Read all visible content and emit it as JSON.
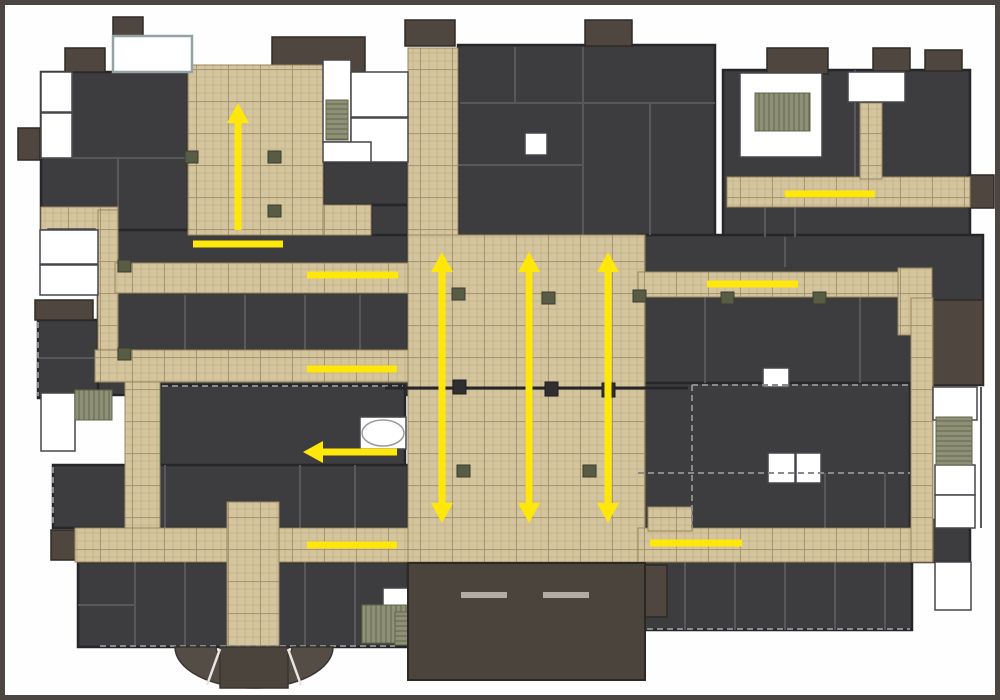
{
  "meta": {
    "diagram_type": "building-floor-plan-circulation",
    "canvas": {
      "w": 990,
      "h": 690
    }
  },
  "palette": {
    "frame": "#4b4641",
    "background": "#fefefe",
    "room_dark": "#3d3d3f",
    "room_wall": "#26262a",
    "interior_wall": "#57575c",
    "accent_block": "#4e463f",
    "accent_stroke": "#2f2a25",
    "corridor_base": "#d4c59e",
    "corridor_grout": "#b8a77e",
    "corridor_grid": "#9c8c66",
    "corridor_stroke": "#97855e",
    "white_room": "#ffffff",
    "white_room_stroke": "#46464c",
    "stairs": "#8e9177",
    "stairs_stripe": "#62654a",
    "column": "#585c45",
    "column_stroke": "#393d2b",
    "entrance_block": "#4a443d",
    "fan": "#544d46",
    "step_bar": "#b2ada4",
    "joint_line": "#262628",
    "dash_line": "#8a8a8a",
    "teal_border": "#93a3a3",
    "arrow_yellow": "#ffe70a"
  },
  "floor_plan": {
    "dark_masses": [
      [
        36,
        67,
        147,
        193
      ],
      [
        93,
        225,
        310,
        165
      ],
      [
        155,
        380,
        245,
        87
      ],
      [
        33,
        315,
        60,
        78
      ],
      [
        48,
        460,
        355,
        63
      ],
      [
        73,
        557,
        330,
        85
      ],
      [
        453,
        40,
        257,
        192
      ],
      [
        718,
        65,
        247,
        167
      ],
      [
        633,
        230,
        345,
        150
      ],
      [
        633,
        378,
        272,
        145
      ],
      [
        630,
        555,
        277,
        70
      ],
      [
        318,
        157,
        85,
        43
      ],
      [
        366,
        200,
        37,
        30
      ],
      [
        905,
        515,
        60,
        42
      ]
    ],
    "accent_blocks": [
      [
        108,
        12,
        30,
        21
      ],
      [
        60,
        43,
        40,
        24
      ],
      [
        267,
        32,
        93,
        35
      ],
      [
        400,
        15,
        50,
        26
      ],
      [
        580,
        15,
        47,
        26
      ],
      [
        762,
        43,
        61,
        26
      ],
      [
        868,
        43,
        37,
        23
      ],
      [
        920,
        45,
        37,
        21
      ],
      [
        13,
        123,
        22,
        32
      ],
      [
        30,
        295,
        58,
        20
      ],
      [
        46,
        525,
        26,
        30
      ],
      [
        928,
        295,
        50,
        85
      ],
      [
        963,
        170,
        26,
        33
      ],
      [
        636,
        560,
        26,
        52
      ]
    ],
    "interior_walls": [
      [
        578,
        42,
        578,
        230
      ],
      [
        455,
        98,
        710,
        98
      ],
      [
        510,
        42,
        510,
        98
      ],
      [
        645,
        98,
        645,
        230
      ],
      [
        453,
        160,
        578,
        160
      ],
      [
        850,
        65,
        850,
        172
      ],
      [
        790,
        200,
        790,
        232
      ],
      [
        760,
        200,
        760,
        232
      ],
      [
        700,
        292,
        700,
        378
      ],
      [
        780,
        232,
        780,
        262
      ],
      [
        855,
        292,
        855,
        378
      ],
      [
        820,
        468,
        820,
        523
      ],
      [
        880,
        468,
        880,
        523
      ],
      [
        180,
        290,
        180,
        345
      ],
      [
        240,
        290,
        240,
        345
      ],
      [
        300,
        290,
        300,
        345
      ],
      [
        355,
        290,
        355,
        345
      ],
      [
        160,
        460,
        160,
        523
      ],
      [
        295,
        460,
        295,
        523
      ],
      [
        350,
        460,
        350,
        523
      ],
      [
        130,
        557,
        130,
        642
      ],
      [
        180,
        557,
        180,
        642
      ],
      [
        300,
        557,
        300,
        642
      ],
      [
        350,
        557,
        350,
        642
      ],
      [
        73,
        600,
        130,
        600
      ],
      [
        680,
        555,
        680,
        625
      ],
      [
        730,
        555,
        730,
        625
      ],
      [
        780,
        555,
        780,
        625
      ],
      [
        830,
        555,
        830,
        625
      ],
      [
        880,
        555,
        880,
        625
      ],
      [
        36,
        153,
        183,
        153
      ],
      [
        113,
        153,
        113,
        202
      ],
      [
        67,
        67,
        67,
        153
      ],
      [
        33,
        353,
        93,
        353
      ],
      [
        520,
        562,
        520,
        670
      ],
      [
        976,
        382,
        976,
        523
      ]
    ],
    "corridors": [
      [
        36,
        202,
        77,
        58
      ],
      [
        183,
        60,
        135,
        170
      ],
      [
        318,
        200,
        48,
        30
      ],
      [
        93,
        205,
        20,
        172
      ],
      [
        110,
        258,
        293,
        30
      ],
      [
        90,
        345,
        313,
        32
      ],
      [
        120,
        377,
        35,
        148
      ],
      [
        70,
        523,
        335,
        34
      ],
      [
        222,
        497,
        52,
        145
      ],
      [
        403,
        43,
        50,
        187
      ],
      [
        403,
        230,
        237,
        327
      ],
      [
        633,
        267,
        262,
        25
      ],
      [
        893,
        263,
        34,
        67
      ],
      [
        906,
        293,
        22,
        264
      ],
      [
        633,
        523,
        273,
        34
      ],
      [
        643,
        502,
        44,
        24
      ],
      [
        722,
        172,
        243,
        30
      ],
      [
        855,
        98,
        22,
        76
      ]
    ],
    "white_rooms": [
      [
        36,
        67,
        31,
        40
      ],
      [
        36,
        108,
        31,
        45
      ],
      [
        43,
        224,
        47,
        36
      ],
      [
        35,
        225,
        58,
        34
      ],
      [
        35,
        260,
        58,
        30
      ],
      [
        318,
        55,
        28,
        82
      ],
      [
        346,
        67,
        57,
        45
      ],
      [
        346,
        113,
        57,
        44
      ],
      [
        318,
        137,
        48,
        20
      ],
      [
        735,
        68,
        82,
        84
      ],
      [
        843,
        67,
        57,
        30
      ],
      [
        763,
        448,
        27,
        30
      ],
      [
        791,
        448,
        25,
        30
      ],
      [
        928,
        382,
        44,
        33
      ],
      [
        930,
        460,
        40,
        30
      ],
      [
        930,
        490,
        40,
        33
      ],
      [
        36,
        388,
        34,
        58
      ],
      [
        378,
        583,
        25,
        25
      ],
      [
        930,
        557,
        36,
        48
      ],
      [
        520,
        128,
        22,
        22
      ],
      [
        758,
        363,
        26,
        19
      ],
      [
        355,
        412,
        46,
        32
      ]
    ],
    "teal_room": [
      108,
      31,
      79,
      36
    ],
    "stairs": [
      [
        321,
        95,
        22,
        40,
        "v"
      ],
      [
        750,
        88,
        55,
        38,
        "h"
      ],
      [
        931,
        412,
        36,
        48,
        "v"
      ],
      [
        70,
        385,
        37,
        30,
        "h"
      ],
      [
        357,
        600,
        46,
        38,
        "h"
      ],
      [
        390,
        607,
        14,
        33,
        "v"
      ]
    ],
    "dashed_lines": [
      [
        687,
        380,
        905,
        380
      ],
      [
        687,
        380,
        687,
        523
      ],
      [
        633,
        468,
        905,
        468
      ],
      [
        632,
        624,
        905,
        624
      ],
      [
        95,
        641,
        390,
        641
      ],
      [
        157,
        381,
        398,
        381
      ],
      [
        33,
        317,
        33,
        391
      ],
      [
        48,
        462,
        48,
        521
      ]
    ],
    "columns": [
      [
        180,
        146
      ],
      [
        263,
        146
      ],
      [
        263,
        200
      ],
      [
        113,
        255
      ],
      [
        113,
        343
      ],
      [
        447,
        283
      ],
      [
        537,
        287
      ],
      [
        628,
        285
      ],
      [
        716,
        287
      ],
      [
        808,
        287
      ],
      [
        452,
        460
      ],
      [
        578,
        460
      ]
    ],
    "joint": {
      "line": [
        380,
        383,
        683,
        383
      ],
      "bumps": [
        [
          448,
          375
        ],
        [
          540,
          377
        ],
        [
          597,
          378
        ]
      ]
    },
    "oval_table": {
      "cx": 378,
      "cy": 428,
      "rx": 21,
      "ry": 13
    },
    "entrance": {
      "block": [
        403,
        558,
        237,
        117
      ],
      "step_bars": [
        [
          456,
          587,
          46,
          6
        ],
        [
          538,
          587,
          46,
          6
        ]
      ]
    },
    "fan": {
      "cx": 249,
      "cy": 642,
      "rx_outer": 79,
      "ry_outer": 41,
      "rx_inner": 38,
      "ry_inner": 20,
      "center_rect": [
        215,
        642,
        68,
        41
      ],
      "dividers": [
        [
          215,
          644,
          202,
          680
        ],
        [
          283,
          644,
          296,
          680
        ]
      ]
    },
    "circulation_marks": [
      {
        "name": "up-arrow-northwest-lobby",
        "x1": 233,
        "y1": 225,
        "x2": 233,
        "y2": 98,
        "heads": [
          "end"
        ]
      },
      {
        "name": "flow-line-northwest-lower",
        "x1": 188,
        "y1": 239,
        "x2": 278,
        "y2": 239,
        "heads": []
      },
      {
        "name": "flow-line-west-corridor-upper",
        "x1": 302,
        "y1": 270,
        "x2": 393,
        "y2": 270,
        "heads": []
      },
      {
        "name": "flow-line-northeast-corridor",
        "x1": 780,
        "y1": 189,
        "x2": 870,
        "y2": 189,
        "heads": []
      },
      {
        "name": "flow-line-east-corridor",
        "x1": 702,
        "y1": 279,
        "x2": 793,
        "y2": 279,
        "heads": []
      },
      {
        "name": "double-arrow-hall-left",
        "x1": 437,
        "y1": 247,
        "x2": 437,
        "y2": 518,
        "heads": [
          "start",
          "end"
        ]
      },
      {
        "name": "double-arrow-hall-center",
        "x1": 524,
        "y1": 247,
        "x2": 524,
        "y2": 518,
        "heads": [
          "start",
          "end"
        ]
      },
      {
        "name": "double-arrow-hall-right",
        "x1": 603,
        "y1": 247,
        "x2": 603,
        "y2": 518,
        "heads": [
          "start",
          "end"
        ]
      },
      {
        "name": "flow-line-west-corridor-mid",
        "x1": 302,
        "y1": 364,
        "x2": 392,
        "y2": 364,
        "heads": []
      },
      {
        "name": "left-arrow-west-room",
        "x1": 392,
        "y1": 447,
        "x2": 298,
        "y2": 447,
        "heads": [
          "end"
        ]
      },
      {
        "name": "flow-line-southwest-corridor",
        "x1": 302,
        "y1": 540,
        "x2": 392,
        "y2": 540,
        "heads": []
      },
      {
        "name": "flow-line-south-corridor",
        "x1": 645,
        "y1": 538,
        "x2": 737,
        "y2": 538,
        "heads": []
      }
    ],
    "arrow_style": {
      "shaft_width": 7,
      "head_length": 20,
      "head_half_width": 11
    }
  }
}
